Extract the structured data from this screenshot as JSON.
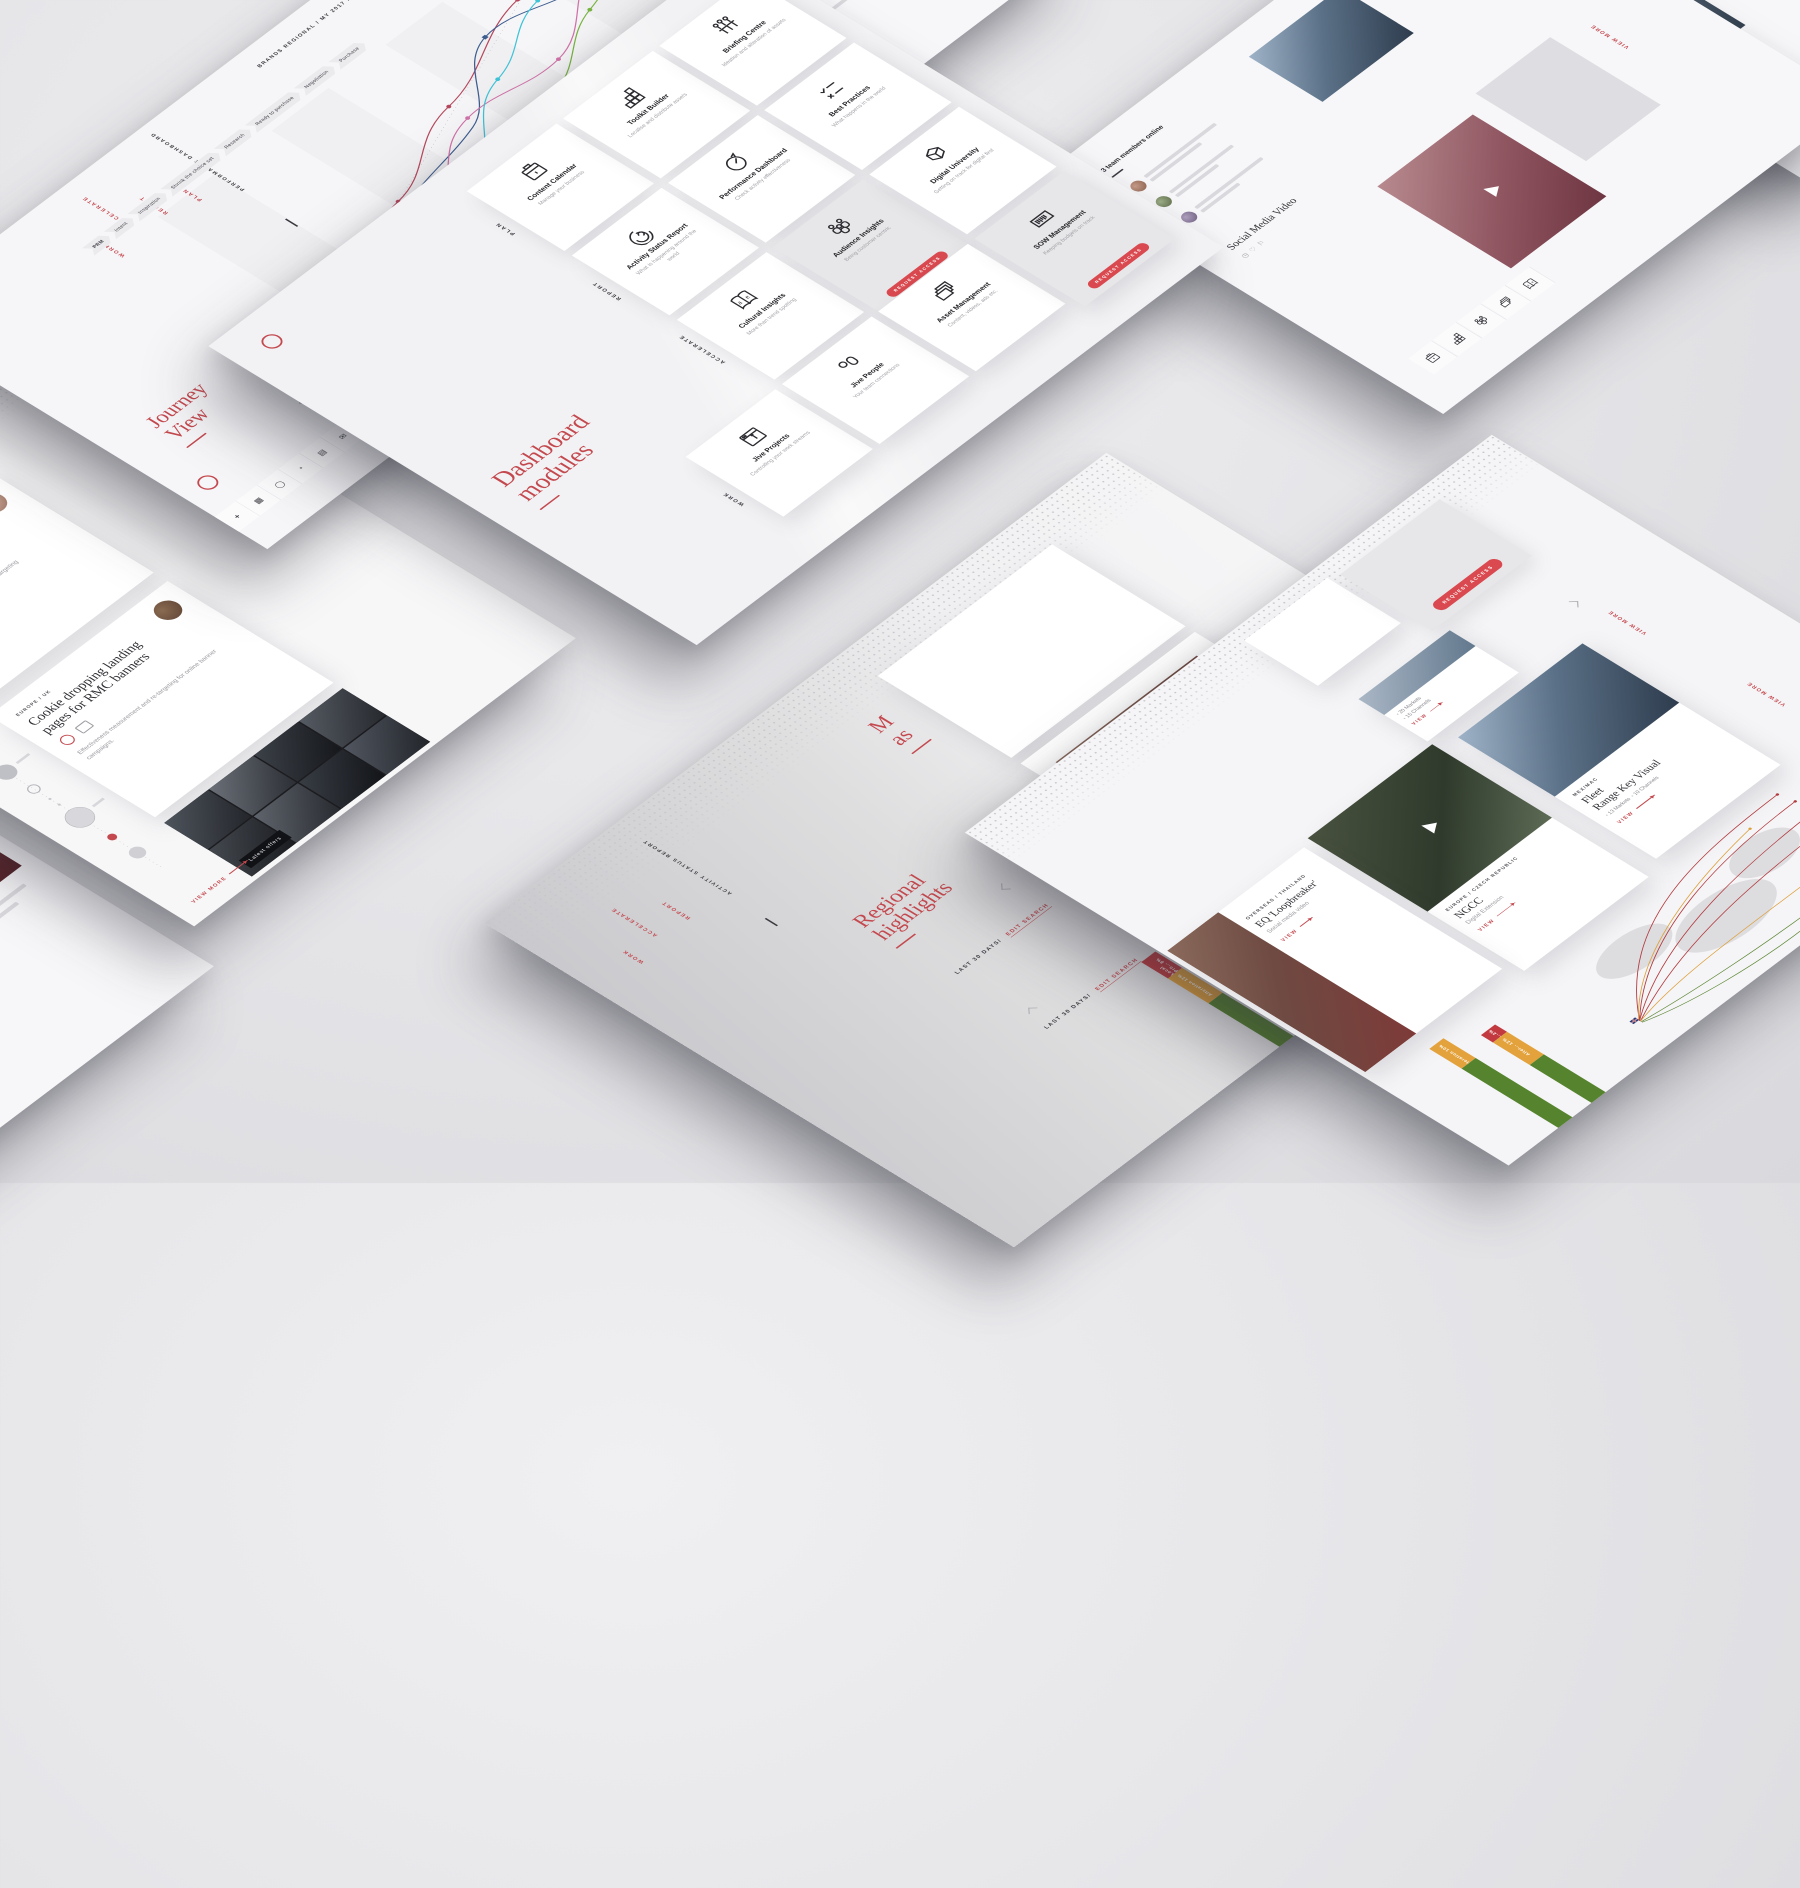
{
  "colors": {
    "accent": "#c4494f",
    "pill_red": "#d9494f",
    "amber": "#e3a23c",
    "green": "#56832d",
    "bar_red": "#c23a3f",
    "navy": "#3d5d8f",
    "magenta": "#d173a8",
    "cyan": "#3fc3d7",
    "lime": "#78b441",
    "crimson": "#b5475c"
  },
  "ui": {
    "view": "VIEW",
    "view_more": "VIEW MORE",
    "request_access": "REQUEST ACCESS",
    "edit_search": "EDIT SEARCH"
  },
  "journey": {
    "nav": [
      "WORK",
      "ACCELERATE",
      "REPORT",
      "PLAN"
    ],
    "perf_label": "PERFORMANCE DASHBOARD",
    "personal_label": "PERSONALISATION",
    "title_line1": "Journey",
    "title_line2": "View",
    "header_meta": "BRANDS REGIONAL / MY 2017 /",
    "zoom_label": "LOW",
    "stages": [
      "PRM",
      "Intent",
      "Inspiration",
      "Shrink the choice set",
      "Research",
      "Ready to purchase",
      "Negotiation",
      "Purchase"
    ],
    "toolbar_glyphs": [
      "+",
      "▦",
      "◯",
      "◔",
      "▤",
      "✉",
      "⚑",
      "◫",
      "☰",
      "▭",
      "◔",
      "▦"
    ]
  },
  "dashboard": {
    "title_line1": "Dashboard",
    "title_line2": "modules",
    "sections": [
      {
        "label": "PLAN",
        "tiles": [
          {
            "name": "Content Calendar",
            "desc": "Manage your business"
          },
          {
            "name": "Toolkit Builder",
            "desc": "Localise and distribute assets"
          },
          {
            "name": "Briefing Centre",
            "desc": "Ideation and alteration of assets"
          }
        ]
      },
      {
        "label": "REPORT",
        "tiles": [
          {
            "name": "Activity Status Report",
            "desc": "What is happening around the world"
          },
          {
            "name": "Performance Dashboard",
            "desc": "Check activity effectiveness"
          },
          {
            "name": "Best Practices",
            "desc": "What happens in the world"
          }
        ]
      },
      {
        "label": "ACCELERATE",
        "tiles": [
          {
            "name": "Cultural Insights",
            "desc": "More than trend spotting"
          },
          {
            "name": "Audience Insights",
            "desc": "Being customer centric"
          },
          {
            "name": "Digital University",
            "desc": "Getting on track for digital first"
          }
        ]
      },
      {
        "label": "WORK",
        "tiles": [
          {
            "name": "Jive Projects",
            "desc": "Controlling your work streams"
          },
          {
            "name": "Jive People",
            "desc": "Your team connections"
          },
          {
            "name": "Asset Management",
            "desc": "Content, videos, ads etc."
          },
          {
            "name": "SOW Management",
            "desc": "Keeping budgets on track"
          }
        ]
      }
    ]
  },
  "left_screen": {
    "period": "LAST 12 MONTHS/",
    "cards": [
      {
        "region": "GREATER CHINA / CHINA",
        "title": "User journey for S-Class buyers",
        "body": "Sophisticated data driven & programmatic targeting mechanism for S-Class prospect."
      },
      {
        "region": "EUROPE / UK",
        "title": "Cookie dropping landing pages for RMC banners",
        "body": "Effectiveness measurement and re-targeting for online banner campaigns."
      }
    ],
    "offers_tag": "Latest offers"
  },
  "regional": {
    "nav": [
      "WORK",
      "ACCELERATE",
      "REPORT"
    ],
    "section_label": "ACTIVITY STATUS REPORT",
    "title_line1": "Regional",
    "title_line2": "highlights",
    "cropped_title_line1": "M",
    "cropped_title_line2": "as",
    "period": "LAST 30 DAYS/",
    "card": {
      "region": "OVERSEAS / THAILAND",
      "title": "EQ 'Loopbreaker'",
      "subtitle": "Social media video"
    },
    "bar": {
      "seg1_label": "Local Pro...",
      "seg1_value": "8%",
      "seg2_label": "Alteration",
      "seg2_value": "12%"
    }
  },
  "right_screen": {
    "stat_card": {
      "markets": "20 Markets",
      "channels": "15 Channels"
    },
    "fleet_card": {
      "region": "MEX/MAC",
      "title_line1": "Fleet",
      "title_line2": "Range Key Visual",
      "markets": "13 Markets",
      "channels": "10 Channels"
    },
    "ngcc_card": {
      "region": "EUROPE / CZECH REPUBLIC",
      "title": "NGCC",
      "subtitle": "Digital Extension"
    },
    "eq_card": {
      "region": "OVERSEAS / THAILAND",
      "title": "EQ 'Loopbreaker'",
      "subtitle": "Social media video"
    },
    "bars": {
      "b1_seg1_label": "Alteration",
      "b1_seg1_value": "10%",
      "b2_seg1_label": "L...",
      "b2_seg1_value": "2%",
      "b2_seg2_label": "Alter...",
      "b2_seg2_value": "12%"
    },
    "countries": [
      "GERMANY",
      "EUROPE"
    ]
  },
  "team_screen": {
    "status": "3 team members online",
    "video_title": "Social Media Video",
    "icon_glyphs": [
      "◷",
      "♡",
      "⚐"
    ]
  }
}
